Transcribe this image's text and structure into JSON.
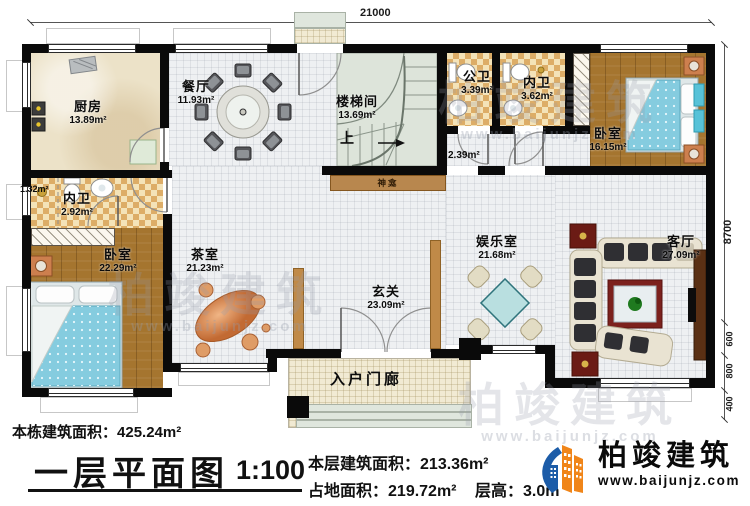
{
  "plan": {
    "dims": {
      "top": "21000",
      "right": "8700",
      "seg1": "600",
      "seg2": "800",
      "seg3": "400"
    },
    "rooms": {
      "kitchen": {
        "label": "厨房",
        "area": "13.89m²"
      },
      "dining": {
        "label": "餐厅",
        "area": "11.93m²"
      },
      "stairwell": {
        "label": "楼梯间",
        "area": "13.69m²"
      },
      "public_bath": {
        "label": "公卫",
        "area": "3.39m²"
      },
      "ensuite_top": {
        "label": "内卫",
        "area": "3.62m²"
      },
      "bedroom_right": {
        "label": "卧室",
        "area": "16.15m²"
      },
      "corridor": {
        "area": "2.39m²"
      },
      "shower": {
        "area": "1.32m²"
      },
      "ensuite_left": {
        "label": "内卫",
        "area": "2.92m²"
      },
      "bedroom_left": {
        "label": "卧室",
        "area": "22.29m²"
      },
      "tea_room": {
        "label": "茶室",
        "area": "21.23m²"
      },
      "foyer": {
        "label": "玄关",
        "area": "23.09m²"
      },
      "rec_room": {
        "label": "娱乐室",
        "area": "21.68m²"
      },
      "living_room": {
        "label": "客厅",
        "area": "27.09m²"
      },
      "porch": {
        "label": "入户门廊"
      },
      "shrine": {
        "label": "神龛"
      },
      "stair_up": {
        "label": "上"
      }
    }
  },
  "footer": {
    "building_area_label": "本栋建筑面积：",
    "building_area_value": "425.24m²",
    "title": "一层平面图",
    "scale": "1:100",
    "floor_area_label": "本层建筑面积：",
    "floor_area_value": "213.36m²",
    "ground_area_label": "占地面积：",
    "ground_area_value": "219.72m²",
    "height_label": "层高：",
    "height_value": "3.0m"
  },
  "brand": {
    "name": "柏竣建筑",
    "url": "www.baijunjz.com"
  },
  "watermark": {
    "text": "柏竣建筑",
    "url": "www.baijunjz.com"
  },
  "colors": {
    "wall": "#0a0a0a",
    "wood_floor": "#a5752f",
    "bed_blue": "#85ccdf",
    "rug_red": "#7c211d",
    "screen_brown": "#c08a48",
    "table_teal": "#b9dfe0",
    "logo_blue": "#1c5ca8",
    "logo_orange": "#f08519"
  }
}
